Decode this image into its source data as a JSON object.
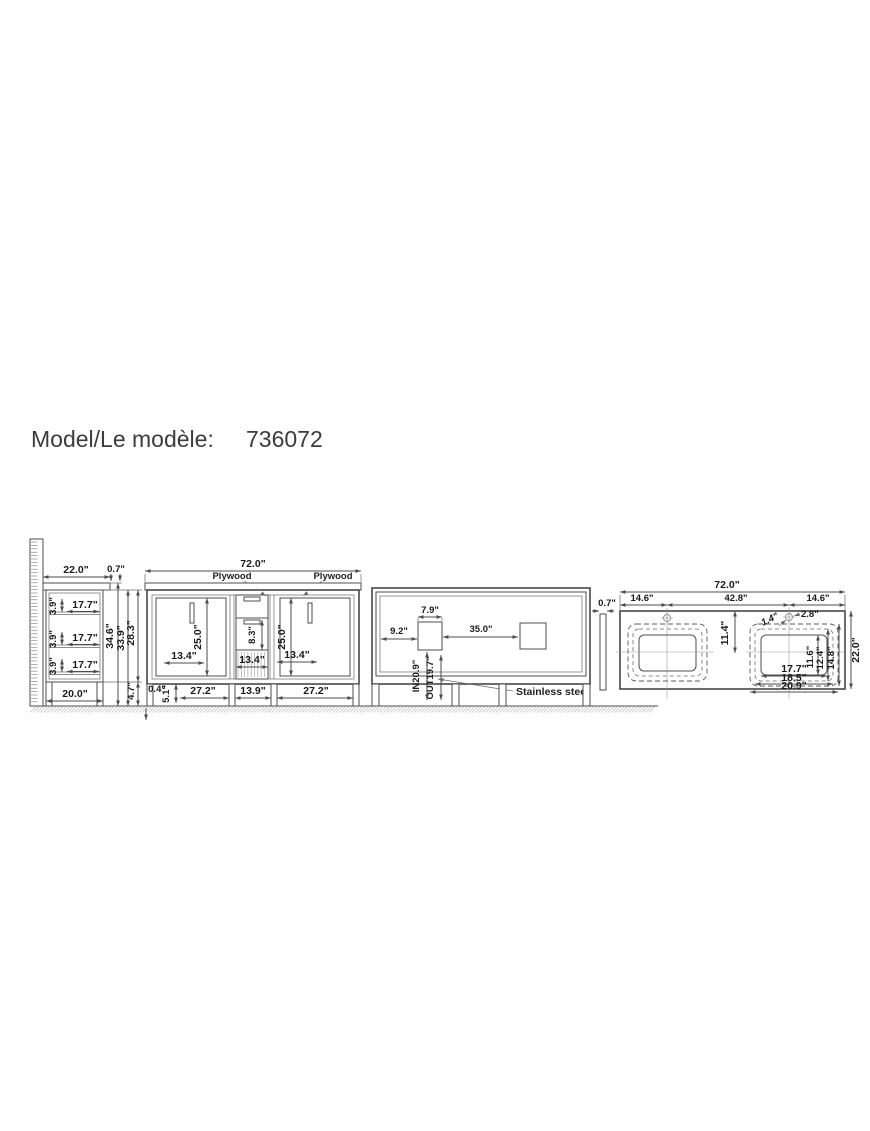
{
  "page": {
    "title_label": "Model/Le modèle:",
    "model_number": "736072"
  },
  "side_view": {
    "counter_depth": "22.0\"",
    "counter_thickness": "0.7\"",
    "shelf_gap_1": "3.9\"",
    "shelf_gap_2": "3.9\"",
    "shelf_gap_3": "3.9\"",
    "shelf_depth_1": "17.7\"",
    "shelf_depth_2": "17.7\"",
    "shelf_depth_3": "17.7\"",
    "base_depth": "20.0\"",
    "total_height": "34.6\"",
    "body_height": "33.9\"",
    "cabinet_height": "28.3\"",
    "leg_height": "4.7\""
  },
  "front_view": {
    "total_width": "72.0\"",
    "material_label_left": "Plywood",
    "material_label_right": "Plywood",
    "door_height_left": "25.0\"",
    "door_height_right": "25.0\"",
    "drawer_height": "8.3\"",
    "door_width_left": "13.4\"",
    "drawer_width": "13.4\"",
    "door_width_right": "13.4\"",
    "bottom_gap": "0.4\"",
    "leg_height": "5.1\"",
    "section_width_left": "27.2\"",
    "section_width_middle": "13.9\"",
    "section_width_right": "27.2\""
  },
  "back_view": {
    "inlet_offset": "9.2\"",
    "inlet_width": "7.9\"",
    "outlet_span": "35.0\"",
    "drain_in_height": "IN20.9\"",
    "drain_out_height": "OUT19.7\"",
    "material_label": "Stainless steel"
  },
  "top_view": {
    "splash_thickness": "0.7\"",
    "total_width": "72.0\"",
    "edge_to_faucet_left": "14.6\"",
    "faucet_spacing": "42.8\"",
    "edge_to_faucet_right": "14.6\"",
    "faucet_to_sink_center": "11.4\"",
    "faucet_hole_diameter": "1.4\"",
    "faucet_hole_offset": "2.8\"",
    "sink_depth_inner": "11.6\"",
    "sink_depth_middle": "12.4\"",
    "sink_depth_outer": "14.8\"",
    "counter_depth": "22.0\"",
    "sink_width_inner": "17.7\"",
    "sink_width_middle": "18.5\"",
    "sink_width_outer": "20.9\""
  }
}
